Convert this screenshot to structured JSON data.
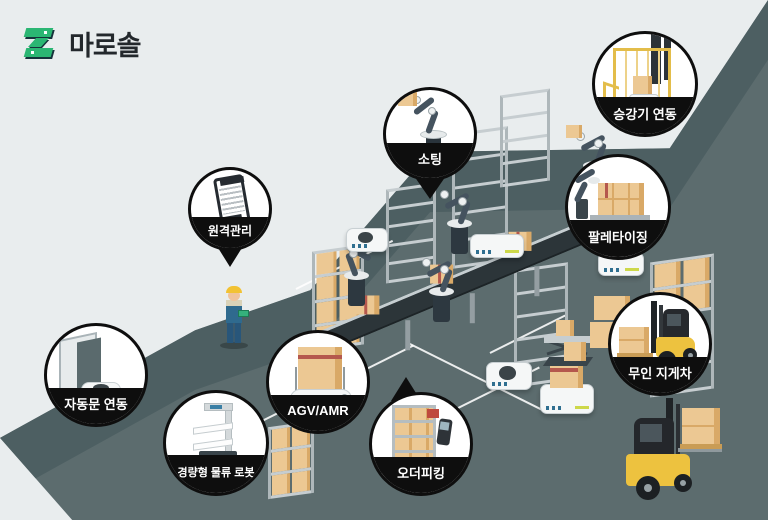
{
  "brand": {
    "name": "마로솔"
  },
  "badges": [
    {
      "id": "sorting",
      "label": "소팅",
      "shape": "pin-down",
      "icon": "robot-arm-with-box-icon"
    },
    {
      "id": "elevator-link",
      "label": "승강기 연동",
      "shape": "circle",
      "icon": "elevator-cage-agv-icon"
    },
    {
      "id": "palletizing",
      "label": "팔레타이징",
      "shape": "circle",
      "icon": "palletizing-robot-icon"
    },
    {
      "id": "remote-management",
      "label": "원격관리",
      "shape": "pin-down",
      "icon": "smartphone-icon"
    },
    {
      "id": "auto-door-link",
      "label": "자동문 연동",
      "shape": "circle",
      "icon": "auto-door-agv-icon"
    },
    {
      "id": "agv-amr",
      "label": "AGV/AMR",
      "shape": "circle",
      "icon": "agv-carrying-box-icon"
    },
    {
      "id": "light-logistics-robot",
      "label": "경량형 물류 로봇",
      "shape": "circle",
      "icon": "shelf-cart-robot-icon"
    },
    {
      "id": "order-picking",
      "label": "오더피킹",
      "shape": "pin-up",
      "icon": "rack-with-scanner-icon"
    },
    {
      "id": "unmanned-forklift",
      "label": "무인 지게차",
      "shape": "circle",
      "icon": "forklift-icon"
    }
  ],
  "colors": {
    "background_light": "#e9edee",
    "background_dark": "#5c6c6e",
    "background_dark_shade": "#4d5f62",
    "badge_black": "#0e0e0e",
    "brand_green": "#2bb673",
    "box_tan": "#ecc893",
    "box_tan_side": "#d9a967",
    "machine_yellow": "#edc23f",
    "robot_slate": "#45535f"
  },
  "scene": {
    "elements": [
      "conveyor-belt",
      "robot-arm",
      "shelf-rack",
      "agv-robot",
      "scissor-lift",
      "box-stack",
      "warehouse-worker",
      "forklift",
      "floor-lane-marking"
    ]
  }
}
